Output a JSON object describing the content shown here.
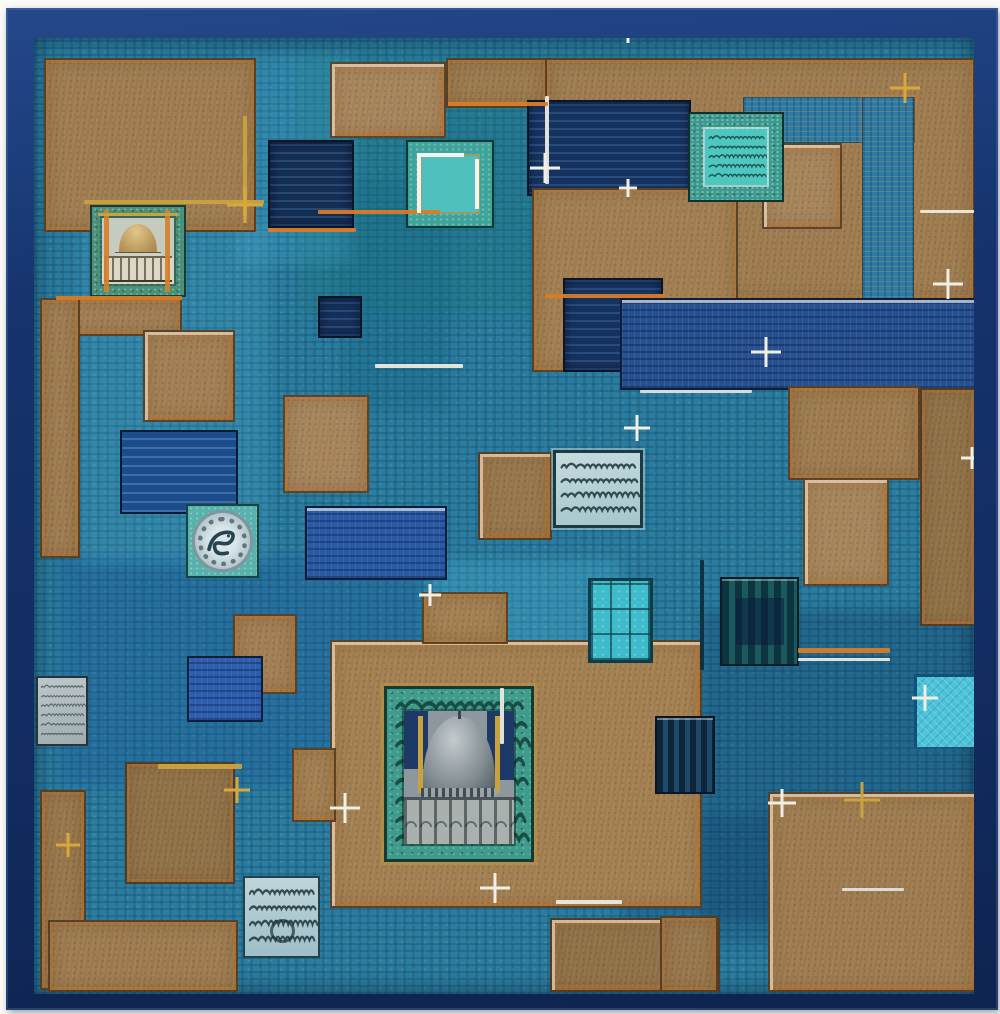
{
  "artwork": {
    "kind": "abstract-painting-photograph",
    "palette": {
      "frame_navy": "#16336e",
      "mat_white": "#fafaf8",
      "canvas_teal": "#2a7da1",
      "ochre_tan": "#9c7a4e",
      "navy_tile": "#16335f",
      "royal_blue": "#2a5aa4",
      "turquoise": "#4ec7c0",
      "bright_cyan": "#4cc3da",
      "orange_accent": "#d97b26",
      "gold_accent": "#c9a23f",
      "silver_grey": "#b5c8ce",
      "script_dark": "#1d333b"
    },
    "washes": [
      {
        "x": 300,
        "y": 55,
        "w": 370,
        "h": 260,
        "c": "rgba(25,115,115,0.30)"
      },
      {
        "x": 60,
        "y": 555,
        "w": 360,
        "h": 230,
        "c": "rgba(25,75,155,0.25)"
      },
      {
        "x": 430,
        "y": 560,
        "w": 190,
        "h": 170,
        "c": "rgba(90,205,235,0.22)"
      },
      {
        "x": 700,
        "y": 610,
        "w": 285,
        "h": 310,
        "c": "rgba(10,40,85,0.25)"
      },
      {
        "x": 80,
        "y": 225,
        "w": 190,
        "h": 340,
        "c": "rgba(95,195,225,0.16)"
      },
      {
        "x": 620,
        "y": 815,
        "w": 360,
        "h": 130,
        "c": "rgba(12,45,95,0.22)"
      },
      {
        "x": 236,
        "y": 55,
        "w": 120,
        "h": 210,
        "c": "rgba(80,190,220,0.18)"
      },
      {
        "x": 340,
        "y": 180,
        "w": 110,
        "h": 230,
        "c": "rgba(15,90,120,0.22)"
      }
    ],
    "tiles": [
      {
        "name": "tan-block-top-left",
        "type": "tan",
        "x": 44,
        "y": 58,
        "w": 212,
        "h": 174,
        "c": "#9d7b4f"
      },
      {
        "name": "tan-block-top-a",
        "type": "tan",
        "x": 330,
        "y": 62,
        "w": 116,
        "h": 76,
        "c": "#a5835a",
        "wEdge": 1
      },
      {
        "name": "tan-block-top-b",
        "type": "tan",
        "x": 446,
        "y": 58,
        "w": 102,
        "h": 50,
        "c": "#9a784c"
      },
      {
        "name": "tan-field-top-right",
        "type": "tan",
        "x": 545,
        "y": 58,
        "w": 430,
        "h": 242,
        "c": "#9c7a4e"
      },
      {
        "name": "blue-band-top-right-h",
        "type": "bluepatch",
        "x": 743,
        "y": 97,
        "w": 172,
        "h": 46
      },
      {
        "name": "blue-band-top-right-v",
        "type": "bluepatch",
        "x": 862,
        "y": 97,
        "w": 52,
        "h": 206
      },
      {
        "name": "tan-inset-top-right",
        "type": "tan",
        "x": 762,
        "y": 143,
        "w": 80,
        "h": 86,
        "c": "#a5835a",
        "wEdge": 1
      },
      {
        "name": "navy-band-top-center",
        "type": "navy",
        "x": 527,
        "y": 100,
        "w": 164,
        "h": 96,
        "c": "#16335f"
      },
      {
        "name": "navy-tile-upper-left",
        "type": "navy",
        "x": 268,
        "y": 140,
        "w": 86,
        "h": 88,
        "c": "#142d52"
      },
      {
        "name": "tan-block-center",
        "type": "tan",
        "x": 532,
        "y": 188,
        "w": 206,
        "h": 184,
        "c": "#a07d50"
      },
      {
        "name": "navy-inset-center",
        "type": "navy",
        "x": 563,
        "y": 278,
        "w": 100,
        "h": 94,
        "c": "#16335f"
      },
      {
        "name": "royal-band-right",
        "type": "royal",
        "x": 620,
        "y": 298,
        "w": 356,
        "h": 92,
        "c": "#27508f",
        "wEdge": 1
      },
      {
        "name": "tan-left-strip",
        "type": "tan",
        "x": 40,
        "y": 298,
        "w": 142,
        "h": 38,
        "c": "#a07d52"
      },
      {
        "name": "tan-left-column",
        "type": "tan",
        "x": 40,
        "y": 298,
        "w": 40,
        "h": 260,
        "c": "#9d7b4f"
      },
      {
        "name": "tan-left-upper",
        "type": "tan",
        "x": 143,
        "y": 330,
        "w": 92,
        "h": 92,
        "c": "#a07d52",
        "wEdge": 1
      },
      {
        "name": "navy-small-square",
        "type": "navy",
        "x": 318,
        "y": 296,
        "w": 44,
        "h": 42,
        "c": "#152f58"
      },
      {
        "name": "tan-mid-left",
        "type": "tan",
        "x": 283,
        "y": 395,
        "w": 86,
        "h": 98,
        "c": "#a5835a"
      },
      {
        "name": "deepblue-tile-left",
        "type": "deepblue",
        "x": 120,
        "y": 430,
        "w": 118,
        "h": 84,
        "c": "#1b4c8c"
      },
      {
        "name": "tan-mid-center",
        "type": "tan",
        "x": 478,
        "y": 452,
        "w": 74,
        "h": 88,
        "c": "#97754a",
        "wEdge": 1
      },
      {
        "name": "royal-tile-center-left",
        "type": "royal",
        "x": 305,
        "y": 506,
        "w": 142,
        "h": 74,
        "c": "#2a5aa4",
        "wEdge": 1
      },
      {
        "name": "tan-right-mid",
        "type": "tan",
        "x": 788,
        "y": 386,
        "w": 132,
        "h": 94,
        "c": "#9c7a4e"
      },
      {
        "name": "tan-right-column",
        "type": "tan",
        "x": 920,
        "y": 388,
        "w": 56,
        "h": 238,
        "c": "#8f7046"
      },
      {
        "name": "tan-right-inset",
        "type": "tan",
        "x": 803,
        "y": 478,
        "w": 86,
        "h": 108,
        "c": "#a5835a",
        "wEdge": 1
      },
      {
        "name": "tan-mid-small",
        "type": "tan",
        "x": 233,
        "y": 614,
        "w": 64,
        "h": 80,
        "c": "#a07d52"
      },
      {
        "name": "royal-tile-lower-left",
        "type": "royal",
        "x": 187,
        "y": 656,
        "w": 76,
        "h": 66,
        "c": "#2d5eae"
      },
      {
        "name": "tan-field-mosque",
        "type": "tan",
        "x": 330,
        "y": 640,
        "w": 372,
        "h": 268,
        "c": "#a17e50",
        "wEdge": 1
      },
      {
        "name": "tan-notch-top",
        "type": "tan",
        "x": 422,
        "y": 592,
        "w": 86,
        "h": 52,
        "c": "#a17e50"
      },
      {
        "name": "tan-notch-left",
        "type": "tan",
        "x": 292,
        "y": 748,
        "w": 44,
        "h": 74,
        "c": "#a17e50"
      },
      {
        "name": "tan-left-square-bottom",
        "type": "tan",
        "x": 125,
        "y": 762,
        "w": 110,
        "h": 122,
        "c": "#8f7046"
      },
      {
        "name": "tan-left-bottom-column",
        "type": "tan",
        "x": 40,
        "y": 790,
        "w": 46,
        "h": 200,
        "c": "#97754a"
      },
      {
        "name": "tan-bottom-left-row",
        "type": "tan",
        "x": 48,
        "y": 920,
        "w": 190,
        "h": 72,
        "c": "#9c7a4e"
      },
      {
        "name": "navy-striped-tile",
        "type": "stripesNavy",
        "x": 655,
        "y": 716,
        "w": 60,
        "h": 78
      },
      {
        "name": "tan-bottom-mid",
        "type": "tan",
        "x": 550,
        "y": 918,
        "w": 170,
        "h": 74,
        "c": "#8f7046",
        "wEdge": 1
      },
      {
        "name": "tan-field-bottom-right",
        "type": "tan",
        "x": 768,
        "y": 792,
        "w": 208,
        "h": 200,
        "c": "#9c7a4e",
        "wEdge": 1
      },
      {
        "name": "tan-bottom-small",
        "type": "tan",
        "x": 660,
        "y": 916,
        "w": 58,
        "h": 76,
        "c": "#97754a"
      },
      {
        "name": "mosque-vignette-gold",
        "type": "mosqueGold",
        "x": 90,
        "y": 205,
        "w": 96,
        "h": 92
      },
      {
        "name": "plate-bird-tile",
        "type": "plate",
        "x": 186,
        "y": 504,
        "w": 73,
        "h": 74
      },
      {
        "name": "calligraphy-panel-center",
        "type": "calligPale",
        "x": 553,
        "y": 450,
        "w": 90,
        "h": 78
      },
      {
        "name": "calligraphy-panel-bottom-left",
        "type": "calligPale2",
        "x": 243,
        "y": 876,
        "w": 77,
        "h": 82
      },
      {
        "name": "calligraphy-panel-silver",
        "type": "calligSilver",
        "x": 36,
        "y": 676,
        "w": 52,
        "h": 70
      },
      {
        "name": "turquoise-calligraphy-tile",
        "type": "turqCallig",
        "x": 688,
        "y": 112,
        "w": 96,
        "h": 90
      },
      {
        "name": "turquoise-tile-white-edges",
        "type": "turqWhite",
        "x": 406,
        "y": 140,
        "w": 88,
        "h": 88
      },
      {
        "name": "turquoise-grid-tile",
        "type": "gridTile",
        "x": 588,
        "y": 578,
        "w": 65,
        "h": 85
      },
      {
        "name": "dark-striped-tile",
        "type": "stripesDark",
        "x": 720,
        "y": 577,
        "w": 79,
        "h": 89
      },
      {
        "name": "cyan-textured-tile",
        "type": "cyanTile",
        "x": 914,
        "y": 674,
        "w": 72,
        "h": 73
      },
      {
        "name": "mosque-vignette-silver",
        "type": "mosqueSilver",
        "x": 384,
        "y": 686,
        "w": 150,
        "h": 176
      }
    ],
    "strokes": [
      {
        "x": 84,
        "y": 200,
        "w": 180,
        "h": 4,
        "c": "#c9a23f"
      },
      {
        "x": 243,
        "y": 116,
        "w": 4,
        "h": 100,
        "c": "#c9a23f"
      },
      {
        "x": 318,
        "y": 210,
        "w": 122,
        "h": 4,
        "c": "#d97b26"
      },
      {
        "x": 545,
        "y": 96,
        "w": 4,
        "h": 88,
        "c": "#eceade"
      },
      {
        "x": 375,
        "y": 364,
        "w": 88,
        "h": 4,
        "c": "#eceade"
      },
      {
        "x": 640,
        "y": 390,
        "w": 112,
        "h": 3,
        "c": "#dde2e0"
      },
      {
        "x": 798,
        "y": 648,
        "w": 92,
        "h": 5,
        "c": "#d97b26"
      },
      {
        "x": 798,
        "y": 658,
        "w": 92,
        "h": 3,
        "c": "#eceade"
      },
      {
        "x": 920,
        "y": 210,
        "w": 56,
        "h": 3,
        "c": "#eceade"
      },
      {
        "x": 556,
        "y": 900,
        "w": 66,
        "h": 4,
        "c": "#eceade"
      },
      {
        "x": 158,
        "y": 764,
        "w": 84,
        "h": 5,
        "c": "#c9a23f"
      },
      {
        "x": 842,
        "y": 888,
        "w": 62,
        "h": 3,
        "c": "#dde2e0"
      },
      {
        "x": 56,
        "y": 296,
        "w": 126,
        "h": 4,
        "c": "#d97b26"
      },
      {
        "x": 448,
        "y": 102,
        "w": 100,
        "h": 4,
        "c": "#d97b26"
      },
      {
        "x": 545,
        "y": 294,
        "w": 120,
        "h": 4,
        "c": "#d97b26"
      },
      {
        "x": 268,
        "y": 228,
        "w": 88,
        "h": 4,
        "c": "#d97b26"
      },
      {
        "x": 700,
        "y": 560,
        "w": 4,
        "h": 110,
        "c": "#0d2f3e"
      },
      {
        "x": 500,
        "y": 688,
        "w": 4,
        "h": 56,
        "c": "#eceade"
      }
    ],
    "sparkles": [
      {
        "x": 245,
        "y": 205,
        "s": 36,
        "c": "#d9a83c"
      },
      {
        "x": 545,
        "y": 168,
        "s": 30,
        "c": "#f0efe6"
      },
      {
        "x": 628,
        "y": 188,
        "s": 18,
        "c": "#f0efe6"
      },
      {
        "x": 905,
        "y": 88,
        "s": 30,
        "c": "#d9a83c"
      },
      {
        "x": 948,
        "y": 284,
        "s": 30,
        "c": "#f0efe6"
      },
      {
        "x": 766,
        "y": 352,
        "s": 30,
        "c": "#f0efe6"
      },
      {
        "x": 637,
        "y": 428,
        "s": 26,
        "c": "#f0efe6"
      },
      {
        "x": 345,
        "y": 808,
        "s": 30,
        "c": "#f0efe6"
      },
      {
        "x": 237,
        "y": 790,
        "s": 26,
        "c": "#d9a83c"
      },
      {
        "x": 68,
        "y": 845,
        "s": 24,
        "c": "#d9a83c"
      },
      {
        "x": 495,
        "y": 888,
        "s": 30,
        "c": "#f0efe6"
      },
      {
        "x": 782,
        "y": 803,
        "s": 28,
        "c": "#f0efe6"
      },
      {
        "x": 862,
        "y": 800,
        "s": 36,
        "c": "#c9a23f"
      },
      {
        "x": 925,
        "y": 698,
        "s": 26,
        "c": "#f0efe6"
      },
      {
        "x": 972,
        "y": 458,
        "s": 22,
        "c": "#f0efe6"
      },
      {
        "x": 628,
        "y": 35,
        "s": 16,
        "c": "#f0efe6"
      },
      {
        "x": 430,
        "y": 595,
        "s": 22,
        "c": "#f0efe6"
      }
    ]
  }
}
